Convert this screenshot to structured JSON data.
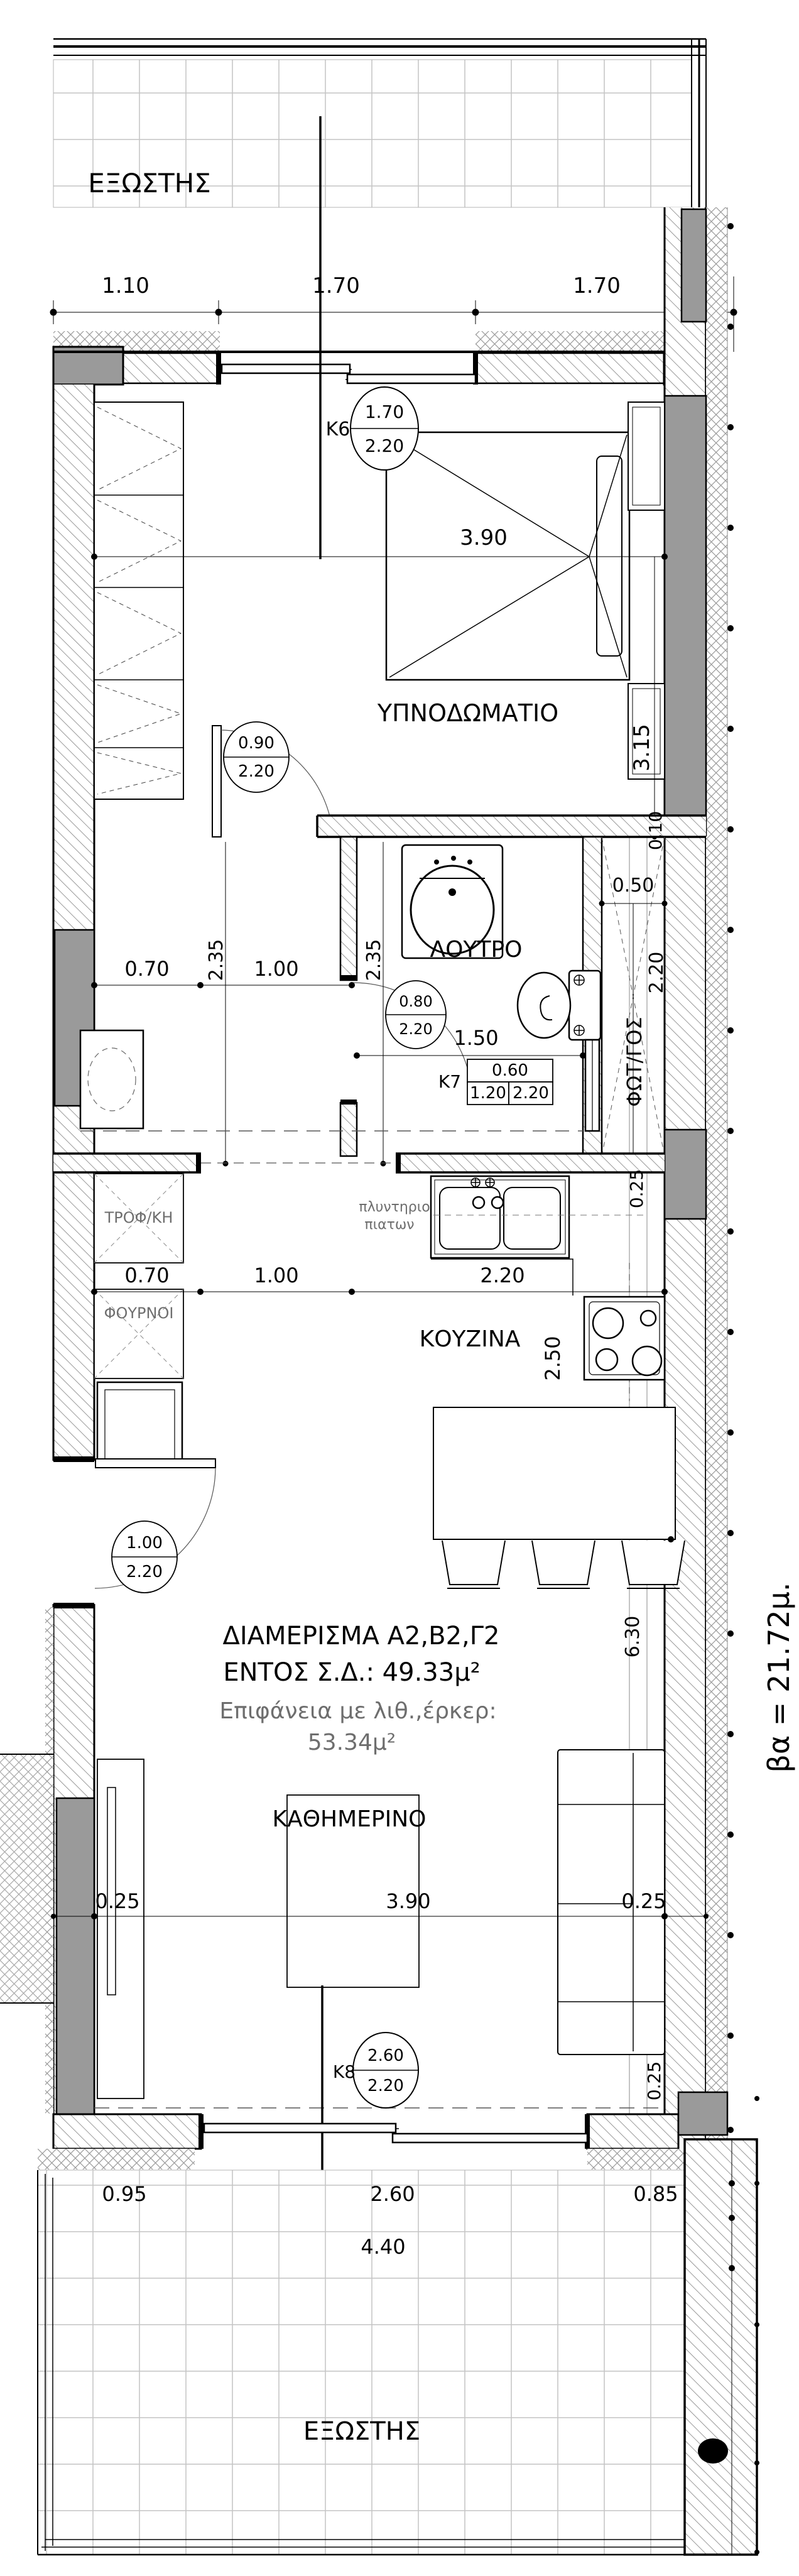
{
  "drawing": {
    "type": "apartment floor plan",
    "side_note": "βα = 21.72μ."
  },
  "rooms": {
    "balcony_top": "ΕΞΩΣΤΗΣ",
    "bedroom": "ΥΠΝΟΔΩΜΑΤΙΟ",
    "bath": "ΛΟΥΤΡΟ",
    "lightwell": "ΦΩΤ/ΓΟΣ",
    "kitchen": "ΚΟΥΖΙΝΑ",
    "living": "ΚΑΘΗΜΕΡΙΝΟ",
    "balcony_bottom": "ΕΞΩΣΤΗΣ",
    "pantry": "ΤΡΟΦ/ΚΗ",
    "ovens": "ΦΟΥΡΝΟΙ",
    "dishwasher_line1": "πλυντηριο",
    "dishwasher_line2": "πιατων"
  },
  "title": {
    "line1": "ΔΙΑΜΕΡΙΣΜΑ Α2,Β2,Γ2",
    "line2": "ΕΝΤΟΣ Σ.Δ.: 49.33μ²",
    "line3": "Επιφάνεια με λιθ.,έρκερ:",
    "line4": "53.34μ²"
  },
  "tags": {
    "k6": {
      "id": "K6",
      "w": "1.70",
      "h": "2.20"
    },
    "bedroom_door": {
      "w": "0.90",
      "h": "2.20"
    },
    "bath_door": {
      "w": "0.80",
      "h": "2.20"
    },
    "k7": {
      "id": "K7",
      "w": "0.60",
      "a": "1.20",
      "b": "2.20"
    },
    "entry_door": {
      "w": "1.00",
      "h": "2.20"
    },
    "k8": {
      "id": "K8",
      "w": "2.60",
      "h": "2.20"
    }
  },
  "dims": {
    "top": [
      "1.10",
      "1.70",
      "1.70"
    ],
    "bedroom": {
      "width": "3.90",
      "depth": "3.15"
    },
    "hall": {
      "wm": "0.70",
      "corridor": "1.00",
      "bath": "1.50",
      "v1": "2.35",
      "v2": "2.35"
    },
    "lightwell": {
      "gap": "0.10",
      "width": "0.50",
      "depth": "2.20"
    },
    "kitchen": {
      "pantry": "0.70",
      "pass": "1.00",
      "counter": "2.20",
      "offset": "0.25",
      "depth": "2.50"
    },
    "living": {
      "left": "0.25",
      "width": "3.90",
      "right": "0.25",
      "depth": "6.30",
      "bottom": "0.25"
    },
    "bottom": [
      "0.95",
      "2.60",
      "0.85"
    ],
    "bottom_total": "4.40"
  },
  "colors": {
    "line": "#000000",
    "concrete_fill": "#9a9a9a",
    "hatch_line": "#808080",
    "grid_line": "#c4c4c4",
    "muted_text": "#6e6e6e"
  }
}
